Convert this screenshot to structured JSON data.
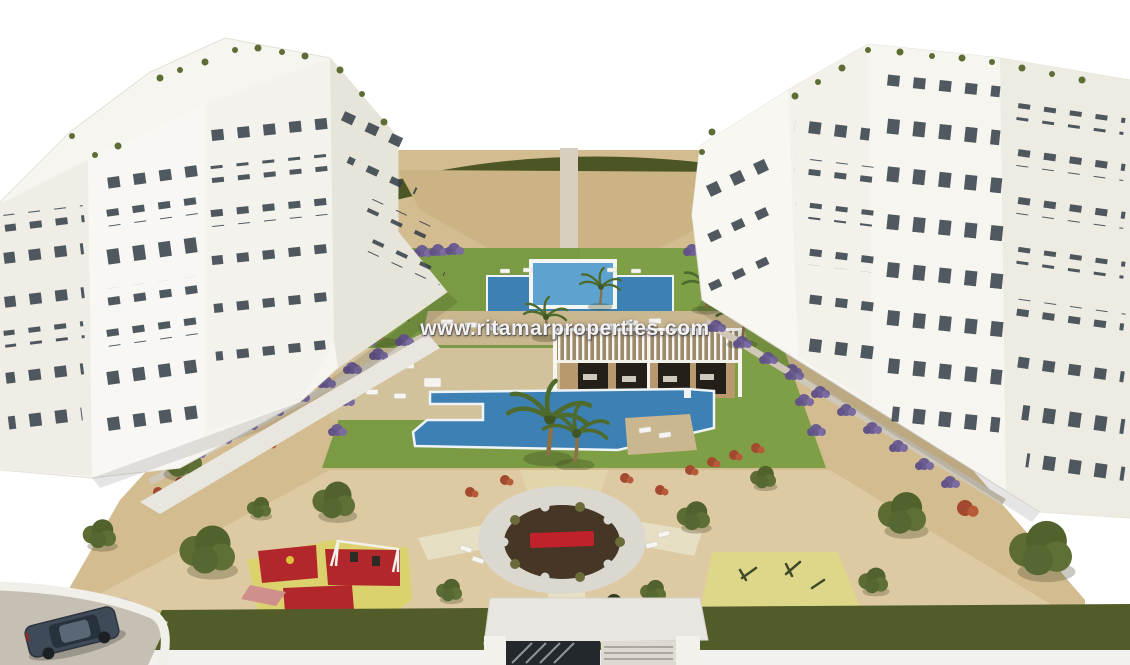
{
  "watermark": {
    "text": "www.ritamarproperties.com"
  },
  "colors": {
    "background": "#ffffff",
    "sand": "#d3bd90",
    "sand_light": "#decda7",
    "grass": "#7a9a43",
    "hedge_top": "#4c5624",
    "hedge_perimeter": "#515c28",
    "pool": "#3c80b4",
    "pool_raised": "#5ea3cf",
    "deck": "#cbb78f",
    "pergola_wall": "#b8986d",
    "plaza_ring": "#dbd8d0",
    "plaza_center": "#463626",
    "bench_red": "#c0212b",
    "playground_yellow": "#dbd26d",
    "playground_red": "#b2272b",
    "fitness_yellow": "#ded789",
    "purple_shrub": "#6c5d91",
    "red_shrub": "#a2492f",
    "tree_olive": "#56682f",
    "building_white": "#f6f5f0",
    "window_dark": "#333d47",
    "walkway": "#e8e6df",
    "road": "#c6c0b4",
    "car_body": "#3e4a58"
  }
}
